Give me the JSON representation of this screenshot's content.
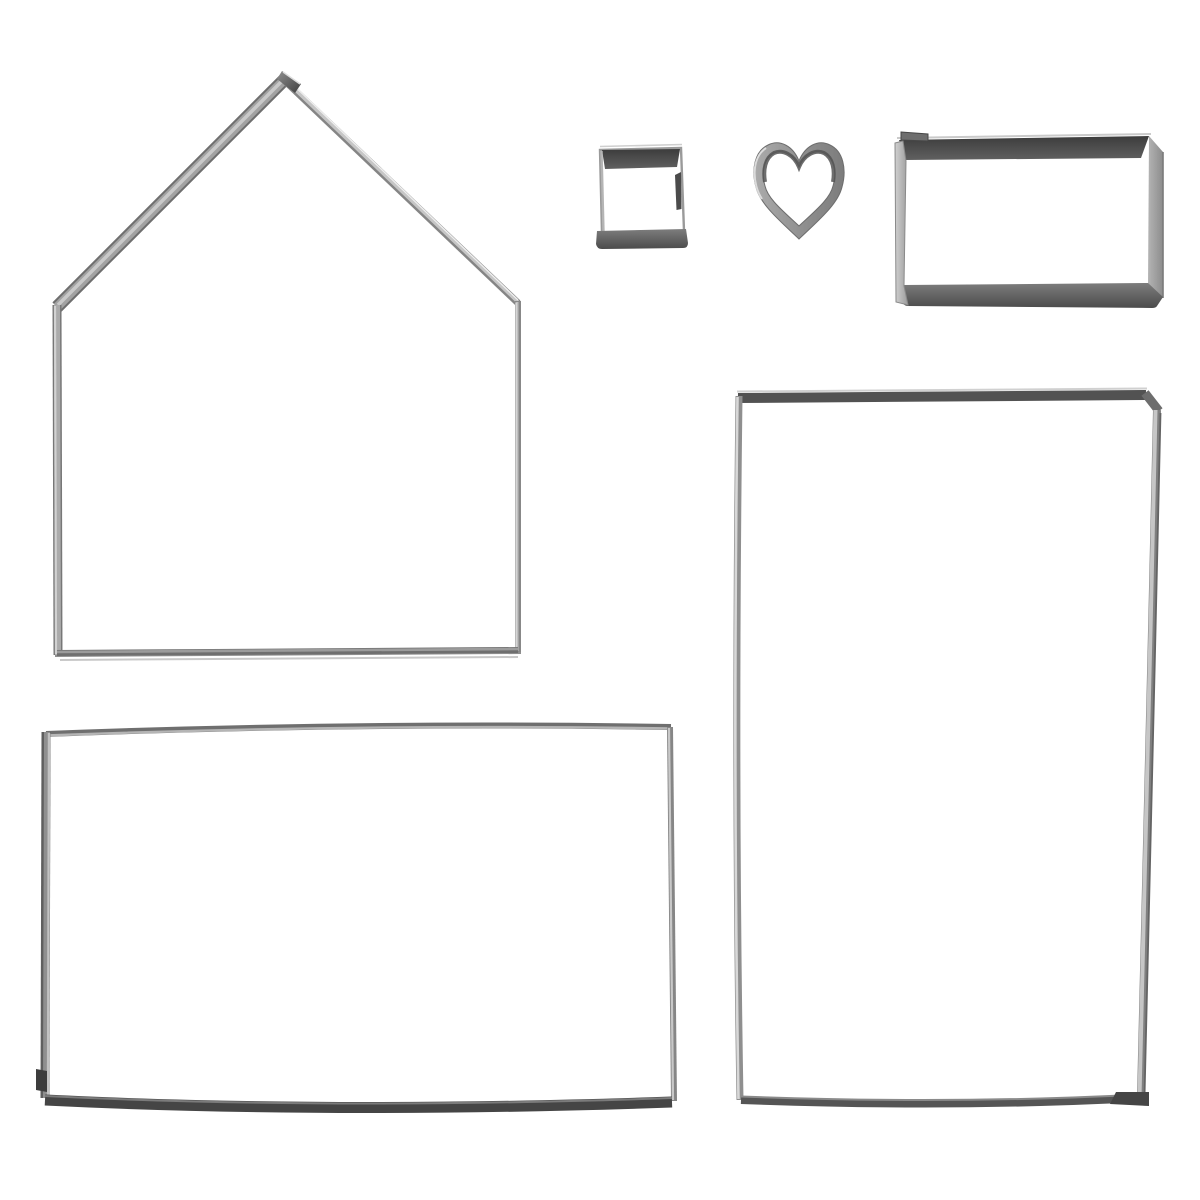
{
  "scene": {
    "type": "product-photo",
    "subject": "Set of six stainless steel cookie cutters on a white background (gingerbread-house baking cutter set)",
    "background_color": "#ffffff",
    "items": [
      {
        "key": "house",
        "label": "House-shaped cookie cutter (pentagon gable piece), top left",
        "shape": "house-pentagon",
        "position": "top-left"
      },
      {
        "key": "square",
        "label": "Small square cookie cutter, top middle",
        "shape": "square",
        "position": "top-middle"
      },
      {
        "key": "heart",
        "label": "Small heart cookie cutter, top middle-right",
        "shape": "heart",
        "position": "top-middle-right"
      },
      {
        "key": "small_rect",
        "label": "Small rectangle cookie cutter, top right",
        "shape": "rectangle",
        "position": "top-right"
      },
      {
        "key": "landscape_rect",
        "label": "Large landscape rectangle cookie cutter, bottom left",
        "shape": "rectangle",
        "position": "bottom-left"
      },
      {
        "key": "portrait_rect",
        "label": "Large portrait rectangle cookie cutter, right side",
        "shape": "rectangle",
        "position": "right"
      }
    ],
    "colors": {
      "metal_highlight": "#e8e8e8",
      "metal_light": "#c4c4c4",
      "metal_mid": "#9a9a9a",
      "metal_dark": "#555555",
      "metal_darkest": "#3f3f3f"
    }
  }
}
